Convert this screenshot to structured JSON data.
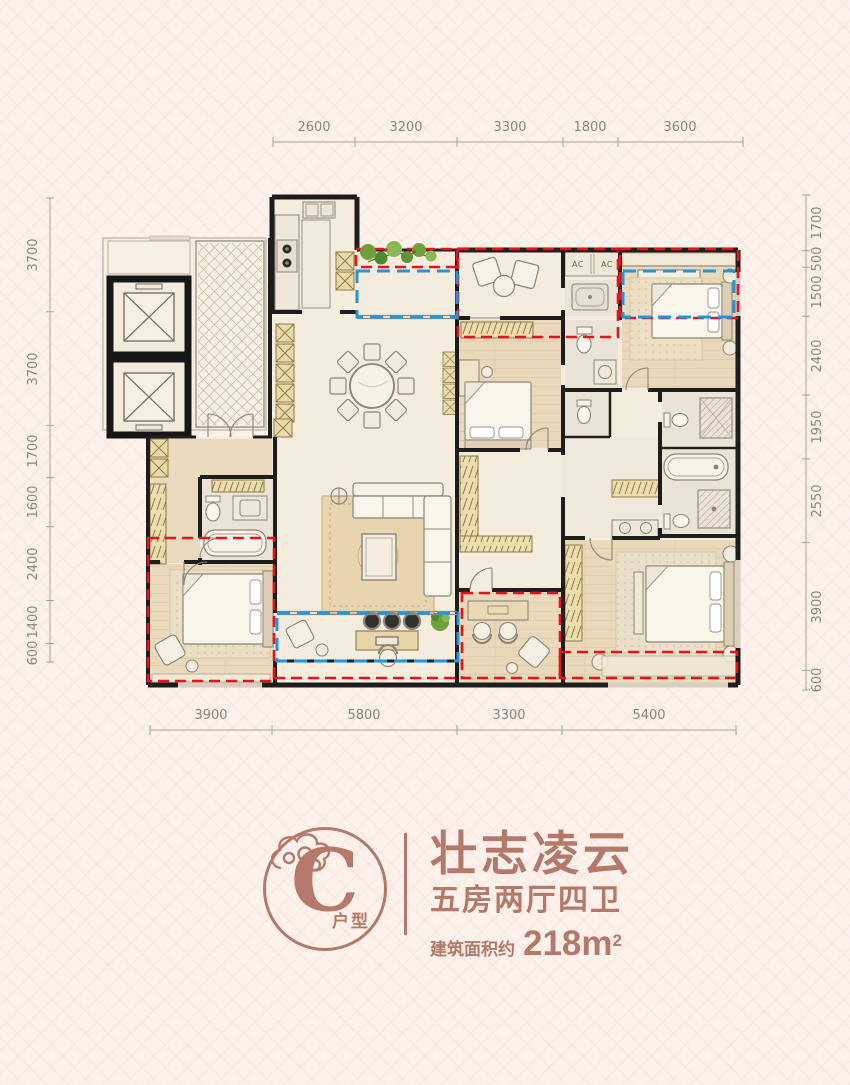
{
  "dimensions": {
    "top": [
      "2600",
      "3200",
      "3300",
      "1800",
      "3600"
    ],
    "bottom": [
      "3900",
      "5800",
      "3300",
      "5400"
    ],
    "left": [
      "3700",
      "3700",
      "1700",
      "1600",
      "2400",
      "1400",
      "600"
    ],
    "right": [
      "1700",
      "500",
      "1500",
      "2400",
      "1950",
      "2550",
      "3900",
      "600"
    ]
  },
  "plan": {
    "ac_left": "AC",
    "ac_right": "AC"
  },
  "title_block": {
    "unit_letter": "C",
    "unit_label": "户型",
    "name": "壮志凌云",
    "layout": "五房两厅四卫",
    "area_prefix": "建筑面积约",
    "area_value": "218m",
    "area_sup": "2"
  },
  "colors": {
    "accent": "#b4796b",
    "red_overlay": "#e8121d",
    "blue_overlay": "#2196dd",
    "wall": "#1d1d1d"
  }
}
